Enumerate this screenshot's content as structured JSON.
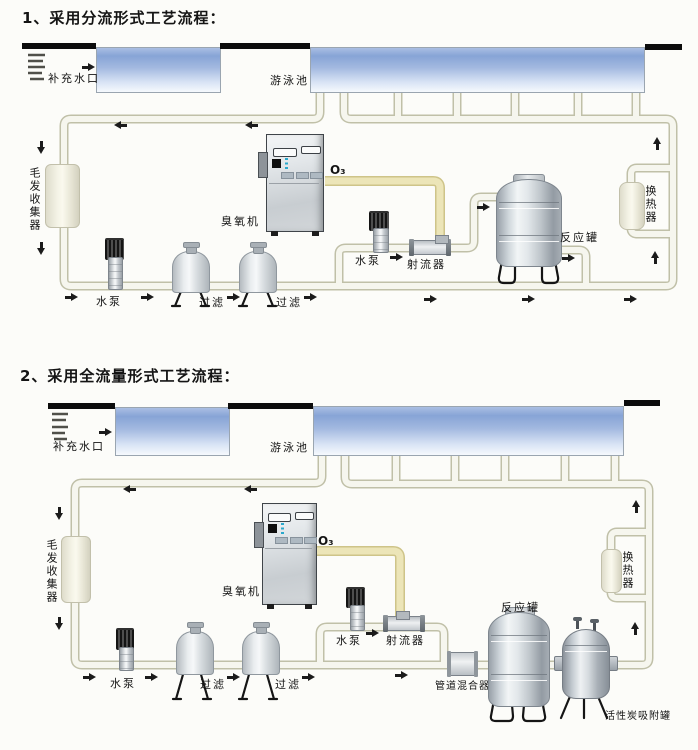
{
  "page": {
    "background": "#fcfcf9",
    "type": "scanned process flow diagram, swimming pool ozone water treatment"
  },
  "colors": {
    "pipe_fill": "#f6f6ee",
    "pipe_edge": "#c0c0a8",
    "ozone_line": "#ece5b8",
    "ozone_line_edge": "#cec489",
    "water_top": "#87a4d6",
    "water_bottom": "#f6f9fd",
    "deck": "#0c0c0c",
    "arrow": "#1b1b1b"
  },
  "icons": {
    "flow_arrow": "solid flow-direction arrow (tail + triangle head)"
  },
  "diagram1": {
    "title": "1、采用分流形式工艺流程：",
    "labels": {
      "makeup_inlet": "补充水口",
      "pool": "游泳池",
      "hair_collector": "毛发收集器",
      "ozone_machine": "臭氧机",
      "ozone_gas": "O₃",
      "pump": "水泵",
      "filter": "过滤",
      "ejector": "射流器",
      "reaction_tank": "反应罐",
      "heat_exchanger": "换热器"
    }
  },
  "diagram2": {
    "title": "2、采用全流量形式工艺流程：",
    "labels": {
      "makeup_inlet": "补充水口",
      "pool": "游泳池",
      "hair_collector": "毛发收集器",
      "ozone_machine": "臭氧机",
      "ozone_gas": "O₃",
      "pump": "水泵",
      "filter": "过滤",
      "ejector": "射流器",
      "pipe_mixer": "管道混合器",
      "reaction_tank": "反应罐",
      "carbon_tank": "活性炭吸附罐",
      "heat_exchanger": "换热器"
    }
  }
}
